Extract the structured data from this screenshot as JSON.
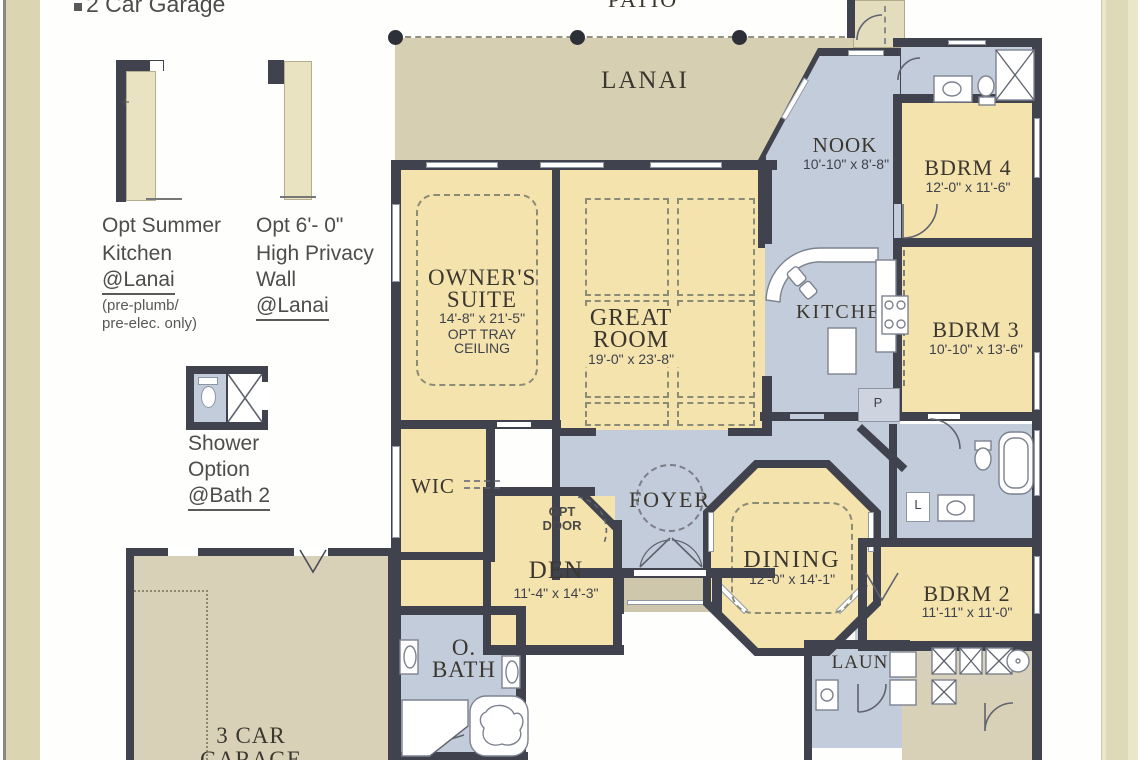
{
  "patio": {
    "label": "PATIO"
  },
  "lanai": {
    "label": "LANAI"
  },
  "notes": {
    "garage_bullet": "2 Car Garage",
    "summer_kitchen": {
      "l1": "Opt Summer",
      "l2": "Kitchen",
      "l3": "@Lanai",
      "s1": "(pre-plumb/",
      "s2": "pre-elec. only)"
    },
    "privacy_wall": {
      "l1": "Opt 6'- 0\"",
      "l2": "High Privacy",
      "l3": "Wall",
      "l4": "@Lanai"
    },
    "shower_option": {
      "l1": "Shower",
      "l2": "Option",
      "l3": "@Bath 2"
    },
    "plus_mark": "+"
  },
  "rooms": {
    "nook": {
      "name": "NOOK",
      "dims": "10'-10\" x 8'-8\""
    },
    "bdrm4": {
      "name": "BDRM 4",
      "dims": "12'-0\" x 11'-6\""
    },
    "owners_suite": {
      "n1": "OWNER'S",
      "n2": "SUITE",
      "dims": "14'-8\" x 21'-5\"",
      "o1": "OPT TRAY",
      "o2": "CEILING"
    },
    "great_room": {
      "n1": "GREAT",
      "n2": "ROOM",
      "dims": "19'-0\" x 23'-8\""
    },
    "kitchen": {
      "name": "KITCHEN",
      "pantry": "P"
    },
    "bdrm3": {
      "name": "BDRM 3",
      "dims": "10'-10\" x 13'-6\""
    },
    "wic": {
      "name": "WIC"
    },
    "foyer": {
      "name": "FOYER"
    },
    "opt_door": {
      "l1": "OPT",
      "l2": "DOOR"
    },
    "den": {
      "name": "DEN",
      "dims": "11'-4\" x 14'-3\""
    },
    "dining": {
      "name": "DINING",
      "dims": "12'-0\" x 14'-1\""
    },
    "bdrm2": {
      "name": "BDRM 2",
      "dims": "11'-11\" x 11'-0\""
    },
    "owners_bath": {
      "n1": "O.",
      "n2": "BATH"
    },
    "laundry": {
      "name": "LAUN"
    },
    "garage3": {
      "n1": "3 CAR",
      "n2": "GARAGE"
    },
    "linen": "L"
  },
  "colors": {
    "wall": "#40424d",
    "room_tan": "#f4e3ad",
    "wet_blue": "#c3ccda",
    "lanai_tan": "#d6cfb1",
    "page_edge": "#dbd5b2"
  }
}
